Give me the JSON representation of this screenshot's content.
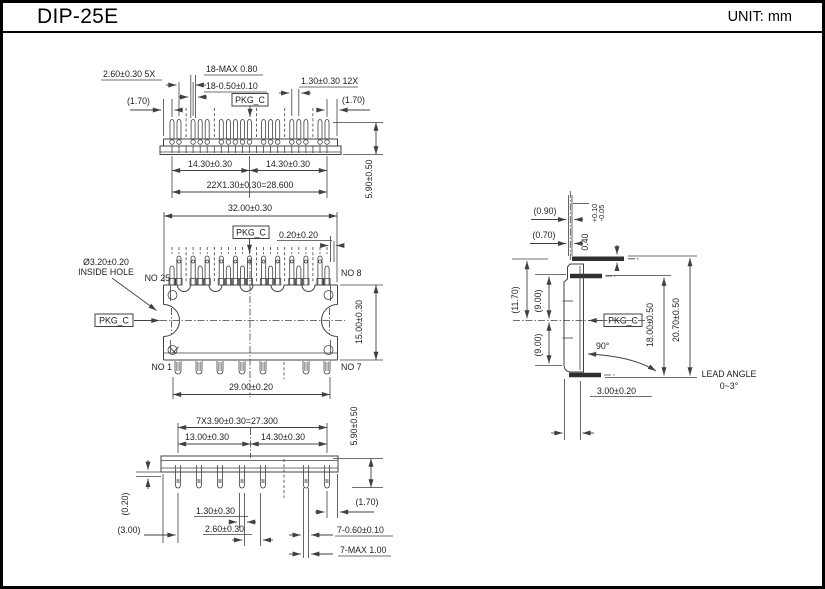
{
  "header": {
    "title": "DIP-25E",
    "unit": "UNIT: mm"
  },
  "labels": {
    "pkg_c": "PKG_C"
  },
  "top_view": {
    "d260_5x": "2.60±0.30 5X",
    "d18_max": "18-MAX 0.80",
    "d18_050": "18-0.50±0.10",
    "d130_12x": "1.30±0.30 12X",
    "r170_left": "(1.70)",
    "r170_right": "(1.70)",
    "d1430_left": "14.30±0.30",
    "d1430_right": "14.30±0.30",
    "d22x": "22X1.30±0.30=28.600",
    "d590": "5.90±0.50"
  },
  "plan_view": {
    "d3200": "32.00±0.30",
    "d020": "0.20±0.20",
    "hole_dia": "Ø3.20±0.20",
    "hole_label": "INSIDE HOLE",
    "no25": "NO 25",
    "no8": "NO 8",
    "no1": "NO 1",
    "no7": "NO 7",
    "d1500": "15.00±0.30",
    "d2900": "29.00±0.20"
  },
  "bottom_view": {
    "d7x390": "7X3.90±0.30=27.300",
    "d1300": "13.00±0.30",
    "d1430": "14.30±0.30",
    "d590": "5.90±0.50",
    "r020": "(0.20)",
    "r300": "(3.00)",
    "d130": "1.30±0.30",
    "d260": "2.60±0.30",
    "r170": "(1.70)",
    "d7_060": "7-0.60±0.10",
    "d7_max": "7-MAX 1.00"
  },
  "side_view": {
    "r090": "(0.90)",
    "r070": "(0.70)",
    "d040": "0.40",
    "tol_plus": "+0.10",
    "tol_minus": "-0.05",
    "r1170": "(11.70)",
    "r900_upper": "(9.00)",
    "r900_lower": "(9.00)",
    "d1800": "18.00±0.50",
    "d2070": "20.70±0.50",
    "a90": "90°",
    "d300": "3.00±0.20",
    "lead_angle_1": "LEAD ANGLE",
    "lead_angle_2": "0~3°"
  }
}
